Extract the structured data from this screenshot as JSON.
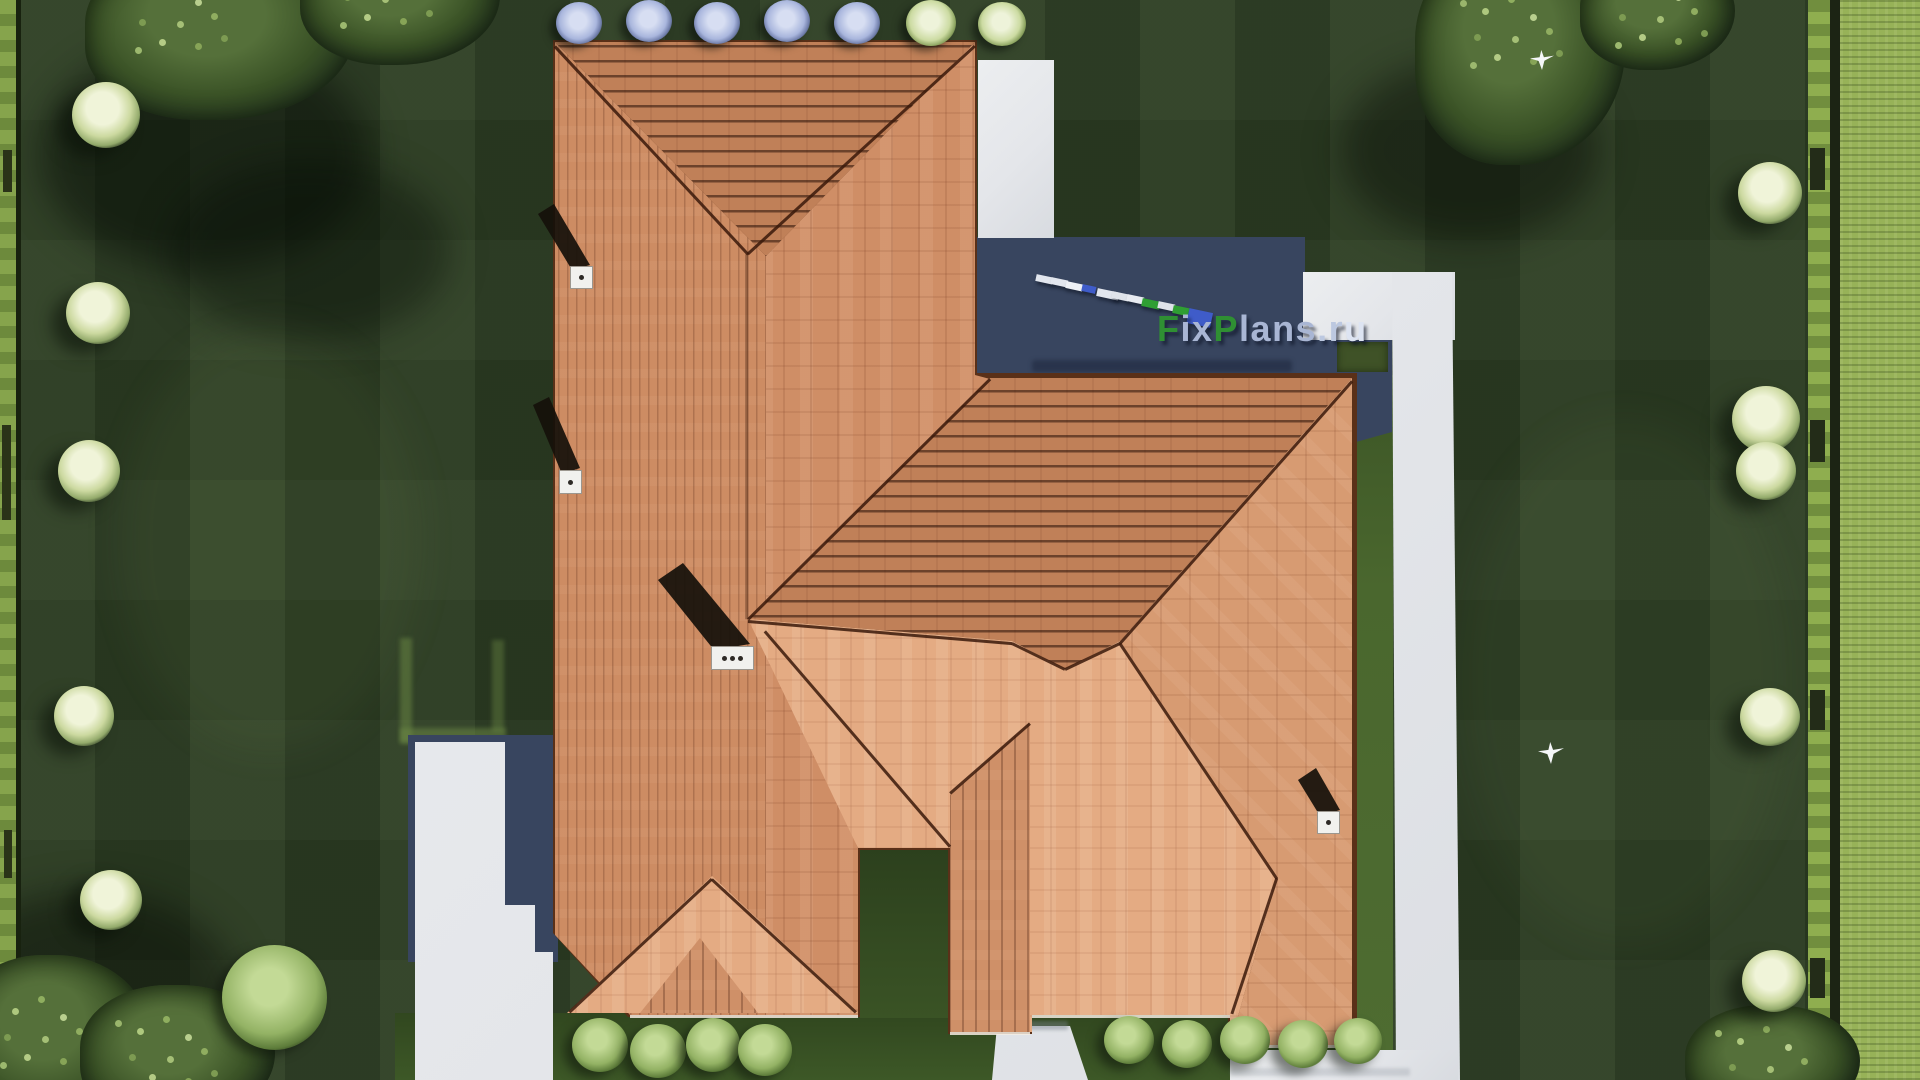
{
  "watermark": {
    "segments": [
      {
        "text": "F",
        "color": "#2f8f33"
      },
      {
        "text": "ix",
        "color": "#a9b6d4"
      },
      {
        "text": "P",
        "color": "#2f8f33"
      },
      {
        "text": "lans",
        "color": "#a9b6d4"
      },
      {
        "text": ".r",
        "color": "#bcc8e0"
      },
      {
        "text": "u",
        "color": "#dde4f2"
      }
    ],
    "dashes": [
      {
        "color": "#e2e6ee",
        "w": 17,
        "h": 7
      },
      {
        "color": "#e2e6ee",
        "w": 17,
        "h": 7
      },
      {
        "color": "#eef1f6",
        "w": 17,
        "h": 7
      },
      {
        "color": "#3f5cc9",
        "w": 14,
        "h": 7
      },
      {
        "color": "#e2e6ee",
        "w": 22,
        "h": 8
      },
      {
        "color": "#dfe3ea",
        "w": 17,
        "h": 7
      },
      {
        "color": "#e8ebf1",
        "w": 17,
        "h": 7
      },
      {
        "color": "#2f9e33",
        "w": 18,
        "h": 8
      },
      {
        "color": "#dfe3ea",
        "w": 17,
        "h": 7
      },
      {
        "color": "#2f9e33",
        "w": 16,
        "h": 8
      },
      {
        "color": "#3f5cc9",
        "w": 24,
        "h": 15
      }
    ]
  },
  "palette": {
    "lawn_dark": "#2b3b22",
    "lawn_lit_strip": "#47642d",
    "hedge_bright": "#8fae4f",
    "concrete_path": "#e8e9ec",
    "house_shadow": "#38455f",
    "roof_mid": "#cf8e66",
    "roof_sunlit": "#e4ab83",
    "roof_striped": "#c08058",
    "watermark_green": "#2f8f33",
    "watermark_blue": "#3f5cc9",
    "watermark_slate": "#a9b6d4"
  }
}
